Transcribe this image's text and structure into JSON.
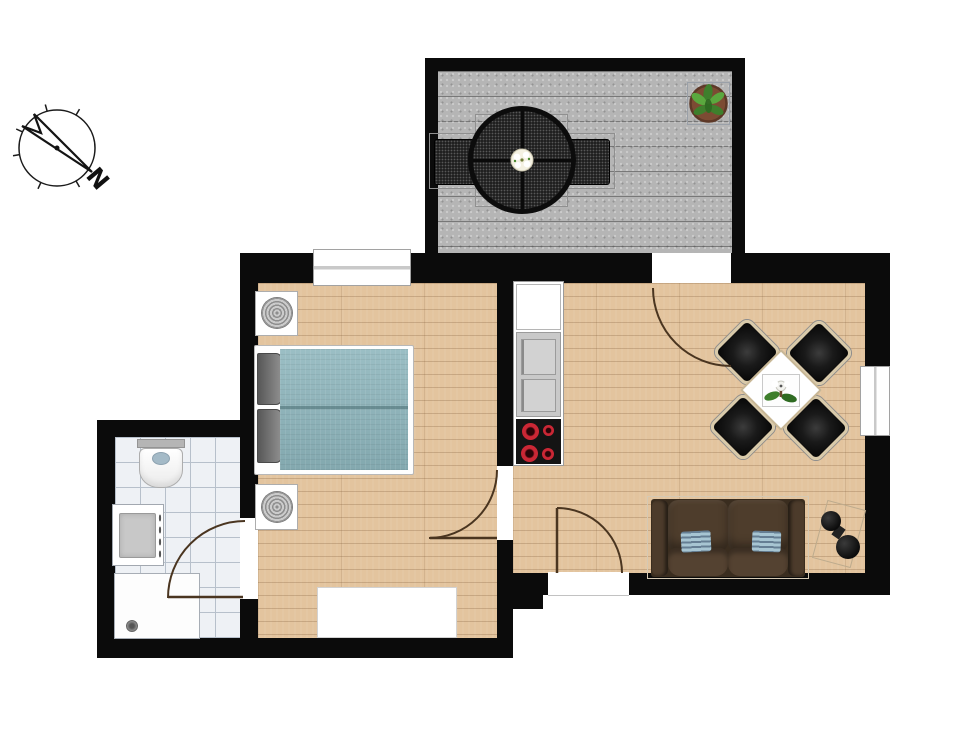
{
  "compass": {
    "north_label": "N"
  },
  "colors": {
    "bg": "#ffffff",
    "wall": "#0b0b0b",
    "wood": "#e3c49e",
    "terrace-floor": "#b5b5b5",
    "tile": "#eef1f5",
    "tile-line": "#b7c0cb",
    "duvet": "#8db5bc",
    "sofa": "#4c3b2b",
    "sofa-dark": "#3a2d1f",
    "sofa-pillow": "#a7c5d2",
    "chair-frame": "#d9caaa",
    "burner": "#cb2735",
    "appliance": "#c9c9c9",
    "door": "#4a3520",
    "leaf-green": "#3e7f2c",
    "leaf-green-2": "#5aa83e",
    "pot": "#7c4b33",
    "compass-ink": "#1a1a1a"
  },
  "legend": {
    "rooms": [
      "terrace",
      "bedroom",
      "bathroom",
      "living-room-with-kitchen"
    ],
    "items": [
      "compass-north-arrow",
      "patio-table",
      "patio-chairs",
      "potted-plant",
      "double-bed",
      "nightstand-lamps",
      "rug",
      "toilet",
      "sink-vanity",
      "shower-tray",
      "fridge",
      "cooktop-4-burners",
      "dining-table-with-4-chairs",
      "sofa-with-cushions",
      "nesting-side-tables",
      "door-swings",
      "windows"
    ]
  }
}
